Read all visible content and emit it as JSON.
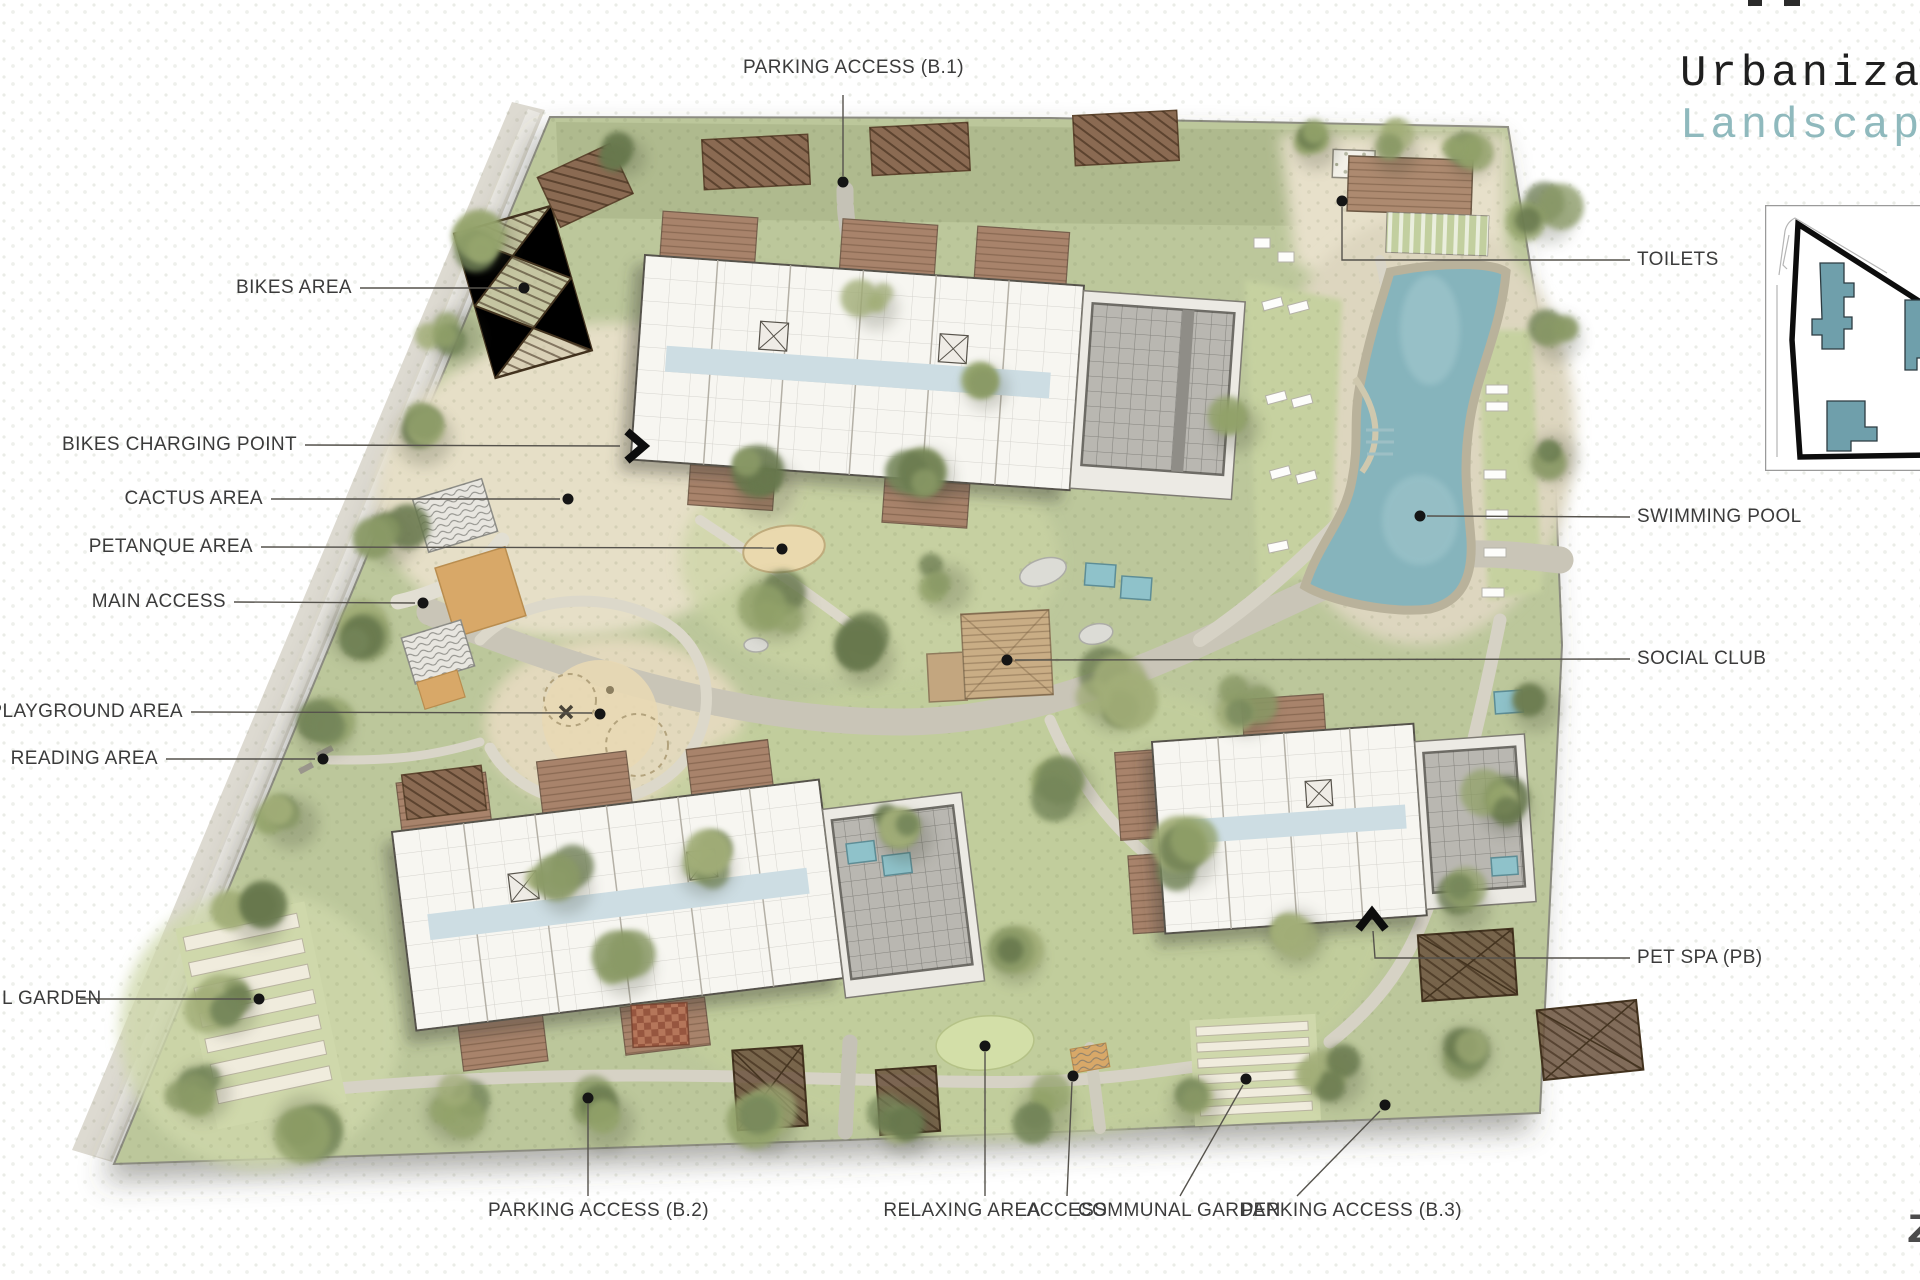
{
  "header": {
    "title_line1": "Urbanizac",
    "title_line2": "Landscape",
    "title_color": "#1f1f1f",
    "subtitle_color": "#8fb9bd"
  },
  "corner_mark": "Z",
  "colors": {
    "site_green": "#bcc79b",
    "lawn_green": "#c8d3a2",
    "sand": "#e6dfc7",
    "path_gray": "#cfccbe",
    "pool_water": "#86b4bc",
    "building_white": "#f7f6f1",
    "garage_gray": "#b9b7b1",
    "deck_brown": "#a8836b",
    "pergola_brown": "#6b523d",
    "label_gray": "#3b3b3b",
    "accent_teal": "#8fb9bd",
    "minimap_building_teal": "#6f9fab"
  },
  "minimap": {
    "building_count": 4,
    "boundary_color": "#111111",
    "frame_color": "#9a9a9a"
  },
  "callouts": [
    {
      "id": "parking-access-b1",
      "label": "PARKING ACCESS (B.1)"
    },
    {
      "id": "bikes-area",
      "label": "BIKES AREA"
    },
    {
      "id": "bikes-charging-point",
      "label": "BIKES CHARGING POINT"
    },
    {
      "id": "cactus-area",
      "label": "CACTUS AREA"
    },
    {
      "id": "petanque-area",
      "label": "PETANQUE AREA"
    },
    {
      "id": "main-access",
      "label": "MAIN ACCESS"
    },
    {
      "id": "playground-area",
      "label": "PLAYGROUND AREA"
    },
    {
      "id": "reading-area",
      "label": "READING AREA"
    },
    {
      "id": "communal-garden-west",
      "fragment": "L",
      "label": "GARDEN"
    },
    {
      "id": "parking-access-b2",
      "label": "PARKING ACCESS (B.2)"
    },
    {
      "id": "relaxing-area",
      "label": "RELAXING AREA"
    },
    {
      "id": "access",
      "label": "ACCESS"
    },
    {
      "id": "communal-garden",
      "label": "COMMUNAL GARDEN"
    },
    {
      "id": "parking-access-b3",
      "label": "PARKING ACCESS (B.3)"
    },
    {
      "id": "toilets",
      "label": "TOILETS"
    },
    {
      "id": "swimming-pool",
      "label": "SWIMMING POOL"
    },
    {
      "id": "social-club",
      "label": "SOCIAL CLUB"
    },
    {
      "id": "pet-spa",
      "label": "PET SPA (PB)"
    }
  ]
}
